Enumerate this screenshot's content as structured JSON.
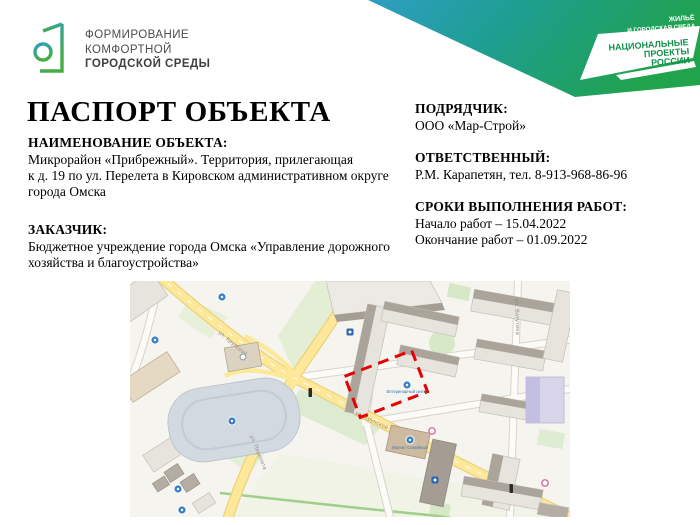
{
  "page": {
    "title": "ПАСПОРТ ОБЪЕКТА"
  },
  "header": {
    "fkgs_logo": {
      "line1": "ФОРМИРОВАНИЕ",
      "line2": "КОМФОРТНОЙ",
      "line3": "ГОРОДСКОЙ СРЕДЫ"
    },
    "banner": {
      "gradient_start": "#2f9ec4",
      "gradient_end": "#21a24c",
      "program_line1": "ЖИЛЬЁ",
      "program_line2": "И ГОРОДСКАЯ СРЕДА",
      "brand_line1": "НАЦИОНАЛЬНЫЕ",
      "brand_line2": "ПРОЕКТЫ",
      "brand_line3": "РОССИИ"
    }
  },
  "sections": {
    "object_name": {
      "heading": "НАИМЕНОВАНИЕ ОБЪЕКТА:",
      "text": "Микрорайон «Прибрежный». Территория, прилегающая\nк д. 19 по ул. Перелета в Кировском административном округе\nгорода Омска"
    },
    "customer": {
      "heading": "ЗАКАЗЧИК:",
      "text": "Бюджетное учреждение города Омска «Управление дорожного\nхозяйства и благоустройства»"
    },
    "contractor": {
      "heading": "ПОДРЯДЧИК:",
      "text": "ООО «Мар-Строй»"
    },
    "responsible": {
      "heading": "ОТВЕТСТВЕННЫЙ:",
      "text": "Р.М. Карапетян, тел. 8-913-968-86-96"
    },
    "work_dates": {
      "heading": "СРОКИ ВЫПОЛНЕНИЯ РАБОТ:",
      "start": "Начало работ – 15.04.2022",
      "end": "Окончание работ – 01.09.2022"
    }
  },
  "map": {
    "marker_color": "#e60000",
    "street_labels": {
      "krupskoy_upper": "ул. Крупской",
      "krupskoy_lower": "ул. Крупской",
      "pereleta": "ул. Перелета",
      "vatutina": "ул. Ватутина"
    },
    "poi_labels": {
      "vet_center": "Ветеринарный центр",
      "magnit": "Магнит Семейный"
    }
  }
}
